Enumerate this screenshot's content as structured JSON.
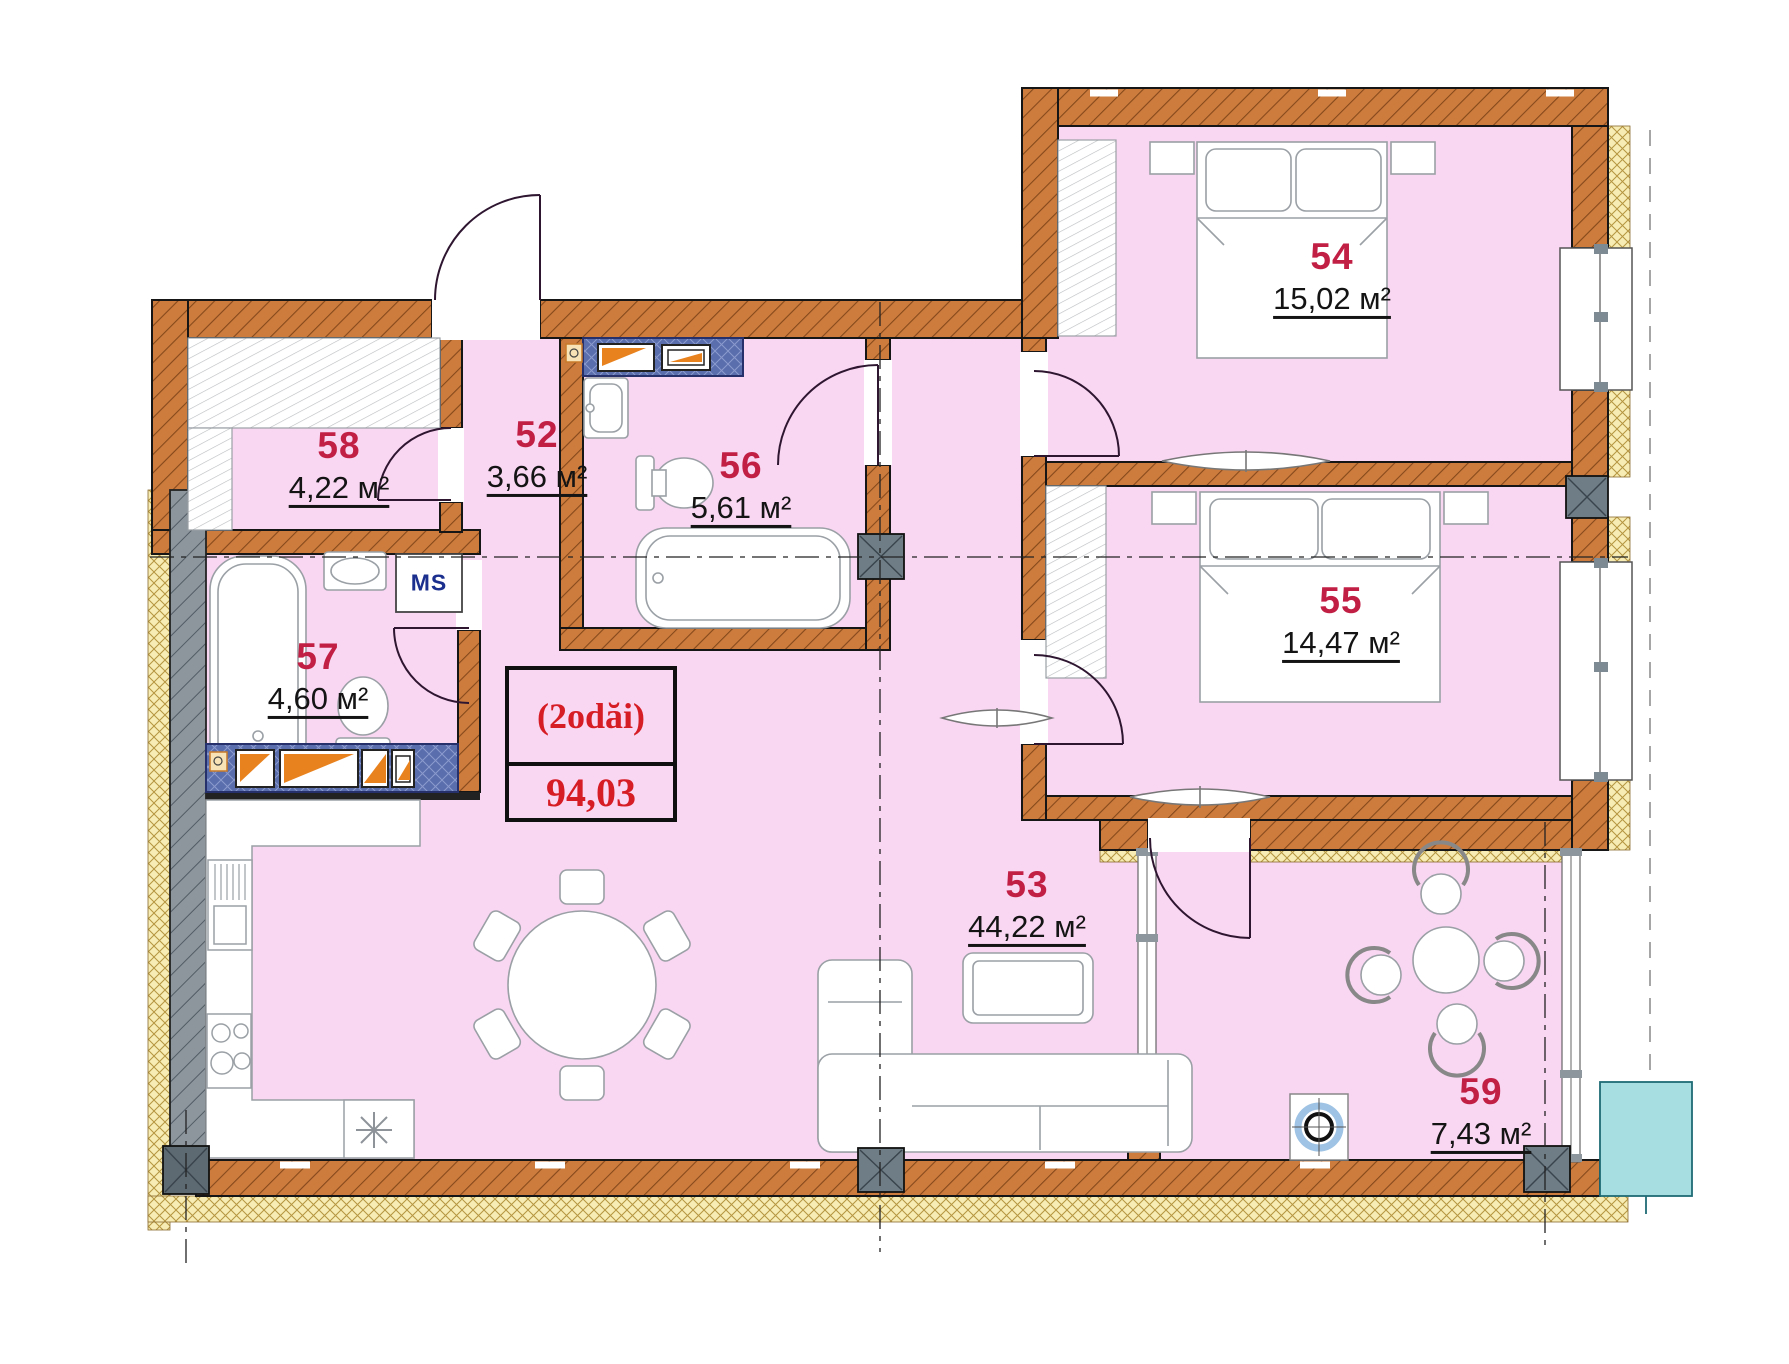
{
  "plan": {
    "unit_label": {
      "rooms_text": "(2odăi)",
      "total_area": "94,03"
    },
    "rooms": [
      {
        "number": "52",
        "area": "3,66 м²"
      },
      {
        "number": "53",
        "area": "44,22 м²"
      },
      {
        "number": "54",
        "area": "15,02 м²"
      },
      {
        "number": "55",
        "area": "14,47 м²"
      },
      {
        "number": "56",
        "area": "5,61 м²"
      },
      {
        "number": "57",
        "area": "4,60 м²"
      },
      {
        "number": "58",
        "area": "4,22 м²"
      },
      {
        "number": "59",
        "area": "7,43 м²"
      }
    ],
    "appliance_labels": {
      "washing_machine": "MS"
    },
    "colors": {
      "wall": "#cd7c3e",
      "insulation": "#f6ecb4",
      "floor_fill": "#f9d6f2",
      "room_number": "#c21f45",
      "unit_label_red": "#d61c24",
      "tile_blue": "#5a6ead",
      "accent_orange": "#e8821e",
      "gray_wall": "#8d969d",
      "balcony_block_teal": "#a7dee2"
    }
  }
}
